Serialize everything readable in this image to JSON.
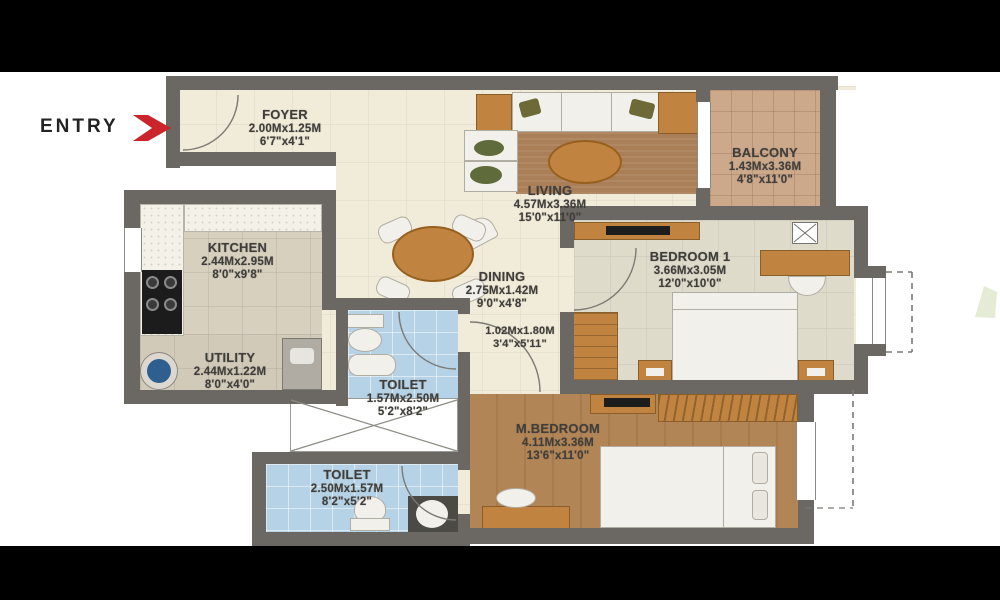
{
  "plan": {
    "entry_label": "ENTRY",
    "rooms": {
      "foyer": {
        "name": "FOYER",
        "metric": "2.00Mx1.25M",
        "imperial": "6'7\"x4'1\""
      },
      "kitchen": {
        "name": "KITCHEN",
        "metric": "2.44Mx2.95M",
        "imperial": "8'0\"x9'8\""
      },
      "utility": {
        "name": "UTILITY",
        "metric": "2.44Mx1.22M",
        "imperial": "8'0\"x4'0\""
      },
      "toilet1": {
        "name": "TOILET",
        "metric": "1.57Mx2.50M",
        "imperial": "5'2\"x8'2\""
      },
      "living": {
        "name": "LIVING",
        "metric": "4.57Mx3.36M",
        "imperial": "15'0\"x11'0\""
      },
      "dining": {
        "name": "DINING",
        "metric": "2.75Mx1.42M",
        "imperial": "9'0\"x4'8\""
      },
      "passage": {
        "name": "",
        "metric": "1.02Mx1.80M",
        "imperial": "3'4\"x5'11\""
      },
      "balcony": {
        "name": "BALCONY",
        "metric": "1.43Mx3.36M",
        "imperial": "4'8\"x11'0\""
      },
      "bedroom1": {
        "name": "BEDROOM 1",
        "metric": "3.66Mx3.05M",
        "imperial": "12'0\"x10'0\""
      },
      "mbedroom": {
        "name": "M.BEDROOM",
        "metric": "4.11Mx3.36M",
        "imperial": "13'6\"x11'0\""
      },
      "toilet2": {
        "name": "TOILET",
        "metric": "2.50Mx1.57M",
        "imperial": "8'2\"x5'2\""
      }
    },
    "colors": {
      "wall": "#6b6762",
      "floor_cream": "#f1ebd9",
      "kitchen_floor": "#d7d0bf",
      "toilet_floor": "#b6d2e6",
      "balcony_floor": "#cda98c",
      "bedroom1_floor": "#dedbcb",
      "wood_floor": "#b28557",
      "furniture_wood": "#c08440",
      "rug": "#aa7f58",
      "entry_arrow_red": "#c9252b",
      "label_text": "#403e3a",
      "letterbox": "#000000"
    }
  }
}
